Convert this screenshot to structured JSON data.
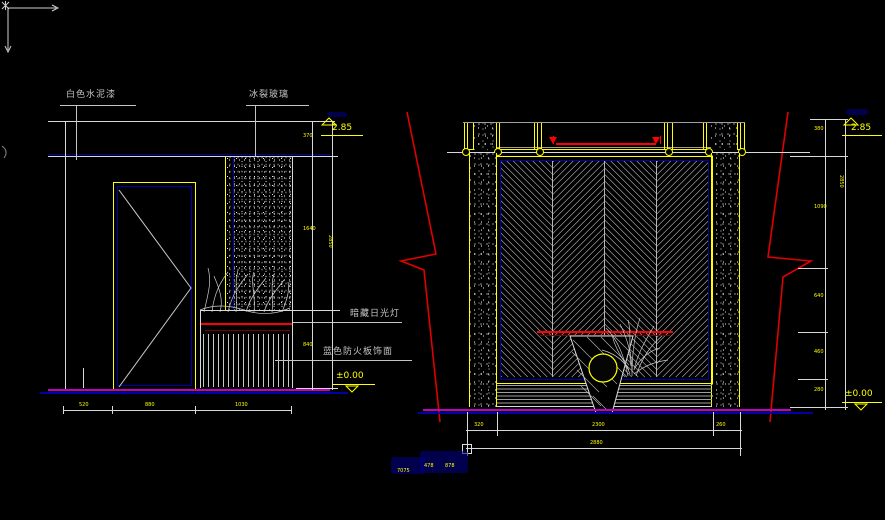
{
  "app": {
    "view": "cad-black-model-space"
  },
  "colors": {
    "background": "#000000",
    "line": "#d9d9d9",
    "dimension_text": "#ffff00",
    "blue": "#0000a8",
    "red": "#ff0000",
    "dark_red": "#7a0000",
    "floor_magenta": "#c400c4",
    "label_gray": "#c4c4c4"
  },
  "drawing": {
    "left": {
      "labels": {
        "paint": "白色水泥漆",
        "glass": "冰裂玻璃",
        "concealed_light": "暗藏日光灯",
        "fire_board": "蓝色防火板饰面"
      },
      "elevation_top": "2.85",
      "elevation_bottom": "±0.00",
      "dims_right": [
        "370",
        "1640",
        "840"
      ],
      "dim_overall": "2850",
      "dims_bottom": [
        "520",
        "880",
        "1030"
      ]
    },
    "right": {
      "elevation_top": "2.85",
      "elevation_bottom": "±0.00",
      "dims_right": [
        "380",
        "1090",
        "640",
        "460",
        "280"
      ],
      "dim_overall": "2850",
      "dims_bottom": [
        "320",
        "2300",
        "260"
      ],
      "dim_bottom_overall": "2880"
    },
    "stray_dims": [
      "7075",
      "478",
      "878"
    ]
  }
}
